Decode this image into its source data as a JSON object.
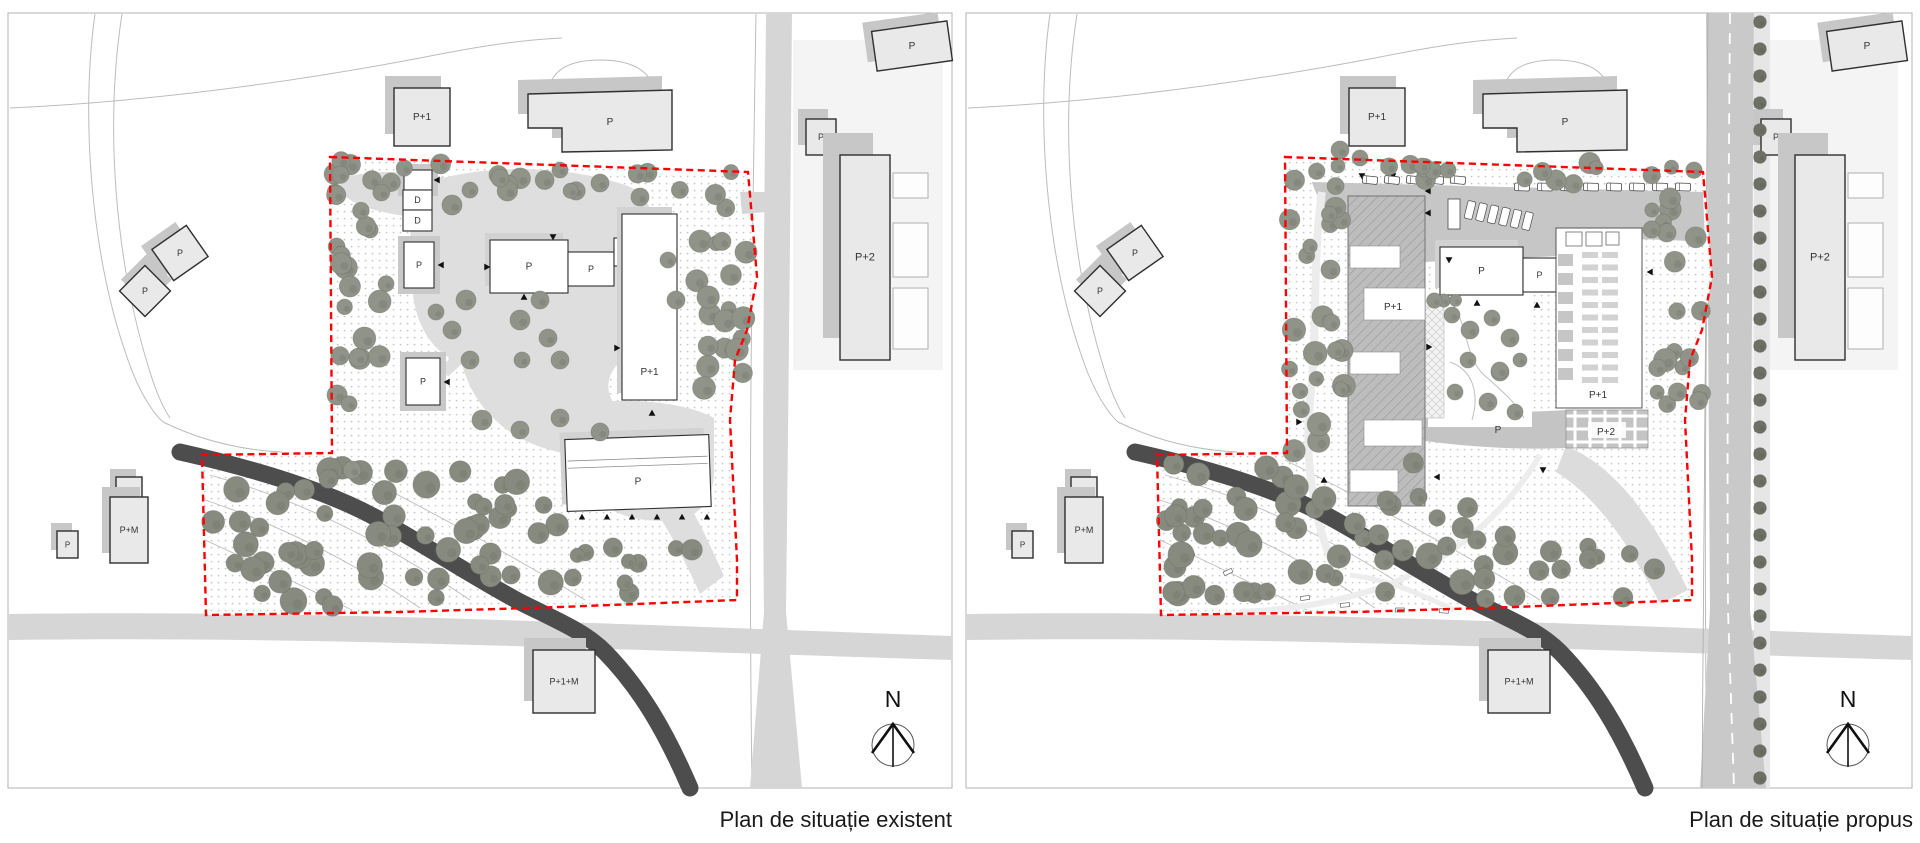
{
  "colors": {
    "boundary_red": "#ff0000",
    "river": "#4d4d4d",
    "road": "#d6d6d6",
    "road_dark": "#c9c9c9",
    "sidewalk": "#e6e6e6",
    "context_building": "#e9e9e9",
    "building_stroke": "#2f2f2f",
    "site_building": "#ffffff",
    "shadow": "#c7c7c7",
    "apron": "#c9c9c9",
    "lawn": "#dedede",
    "parking": "#c6c6c6",
    "slab": "#bdbdbd",
    "dots": "#c8c8c8",
    "tree": "#8f9388",
    "tree_dark": "#6e7266",
    "tree_forest": "#878b7f",
    "tree_street": "#6d7165",
    "label_color": "#333333",
    "frame_stroke": "#b3b3b3",
    "contour": "#bcbcbc"
  },
  "panels": [
    {
      "caption": "Plan de situație existent",
      "north_label": "N",
      "buildings": [
        {
          "label": "P+1",
          "x": 394,
          "y": 88,
          "w": 56,
          "h": 58,
          "kind": "context",
          "ext": [
            -9,
            -12
          ]
        },
        {
          "label": "P",
          "type": "poly",
          "points": [
            [
              528,
              94
            ],
            [
              672,
              90
            ],
            [
              672,
              150
            ],
            [
              562,
              152
            ],
            [
              562,
              128
            ],
            [
              528,
              128
            ]
          ],
          "lx": 610,
          "ly": 122,
          "kind": "context",
          "ext": [
            -10,
            -14
          ]
        },
        {
          "label": "P",
          "x": 806,
          "y": 119,
          "w": 30,
          "h": 36,
          "kind": "context",
          "ext": [
            -8,
            -10
          ],
          "fs": 9
        },
        {
          "label": "P+2",
          "x": 840,
          "y": 155,
          "w": 50,
          "h": 205,
          "kind": "context",
          "ext": [
            -17,
            -22
          ],
          "fs": 11
        },
        {
          "label": "P",
          "x": 874,
          "y": 26,
          "w": 76,
          "h": 40,
          "rot": -8,
          "kind": "context",
          "ext": [
            -8,
            -10
          ]
        },
        {
          "label": "P",
          "x": 159,
          "y": 234,
          "w": 42,
          "h": 38,
          "rot": -35,
          "kind": "context",
          "ext": [
            -7,
            -9
          ],
          "fs": 9
        },
        {
          "label": "P",
          "x": 127,
          "y": 273,
          "w": 36,
          "h": 36,
          "rot": 45,
          "kind": "context",
          "ext": [
            -7,
            -9
          ],
          "fs": 9
        },
        {
          "label": "",
          "x": 116,
          "y": 477,
          "w": 26,
          "h": 21,
          "kind": "context",
          "ext": [
            -6,
            -8
          ]
        },
        {
          "label": "P+M",
          "x": 110,
          "y": 497,
          "w": 38,
          "h": 66,
          "kind": "context",
          "ext": [
            -8,
            -10
          ],
          "fs": 9
        },
        {
          "label": "P",
          "x": 57,
          "y": 531,
          "w": 21,
          "h": 27,
          "kind": "context",
          "ext": [
            -6,
            -8
          ],
          "fs": 8
        },
        {
          "label": "P+1+M",
          "x": 533,
          "y": 650,
          "w": 62,
          "h": 63,
          "kind": "context",
          "ext": [
            -9,
            -12
          ],
          "fs": 9
        },
        {
          "label": "",
          "x": 404,
          "y": 170,
          "w": 28,
          "h": 20,
          "kind": "site",
          "apron": true
        },
        {
          "label": "D",
          "x": 403,
          "y": 190,
          "w": 29,
          "h": 20,
          "kind": "site",
          "fs": 9
        },
        {
          "label": "D",
          "x": 403,
          "y": 210,
          "w": 29,
          "h": 21,
          "kind": "site",
          "fs": 9
        },
        {
          "label": "P",
          "x": 404,
          "y": 242,
          "w": 30,
          "h": 46,
          "kind": "site",
          "apron": true,
          "fs": 9
        },
        {
          "label": "P",
          "x": 406,
          "y": 358,
          "w": 34,
          "h": 47,
          "kind": "site",
          "apron": true,
          "fs": 9
        },
        {
          "label": "P",
          "x": 490,
          "y": 240,
          "w": 78,
          "h": 53,
          "kind": "site"
        },
        {
          "label": "P",
          "x": 568,
          "y": 252,
          "w": 46,
          "h": 34,
          "kind": "site",
          "fs": 9
        },
        {
          "label": "",
          "x": 614,
          "y": 238,
          "w": 26,
          "h": 28,
          "kind": "site"
        },
        {
          "label": "P+1",
          "x": 622,
          "y": 214,
          "w": 55,
          "h": 186,
          "kind": "site",
          "lpy": 0.85
        },
        {
          "label": "P",
          "x": 566,
          "y": 437,
          "w": 144,
          "h": 72,
          "rot": -2,
          "kind": "site",
          "ridges": true
        }
      ]
    },
    {
      "caption": "Plan de situație propus",
      "north_label": "N",
      "buildings": [
        {
          "label": "P+1",
          "x": 1349,
          "y": 88,
          "w": 56,
          "h": 58,
          "kind": "context",
          "ext": [
            -9,
            -12
          ]
        },
        {
          "label": "P",
          "type": "poly",
          "points": [
            [
              1483,
              94
            ],
            [
              1627,
              90
            ],
            [
              1627,
              150
            ],
            [
              1517,
              152
            ],
            [
              1517,
              128
            ],
            [
              1483,
              128
            ]
          ],
          "lx": 1565,
          "ly": 122,
          "kind": "context",
          "ext": [
            -10,
            -14
          ]
        },
        {
          "label": "P",
          "x": 1761,
          "y": 119,
          "w": 30,
          "h": 36,
          "kind": "context",
          "ext": [
            -8,
            -10
          ],
          "fs": 9
        },
        {
          "label": "P+2",
          "x": 1795,
          "y": 155,
          "w": 50,
          "h": 205,
          "kind": "context",
          "ext": [
            -17,
            -22
          ],
          "fs": 11
        },
        {
          "label": "P",
          "x": 1829,
          "y": 26,
          "w": 76,
          "h": 40,
          "rot": -8,
          "kind": "context",
          "ext": [
            -8,
            -10
          ]
        },
        {
          "label": "P",
          "x": 1114,
          "y": 234,
          "w": 42,
          "h": 38,
          "rot": -35,
          "kind": "context",
          "ext": [
            -7,
            -9
          ],
          "fs": 9
        },
        {
          "label": "P",
          "x": 1082,
          "y": 273,
          "w": 36,
          "h": 36,
          "rot": 45,
          "kind": "context",
          "ext": [
            -7,
            -9
          ],
          "fs": 9
        },
        {
          "label": "",
          "x": 1071,
          "y": 477,
          "w": 26,
          "h": 21,
          "kind": "context",
          "ext": [
            -6,
            -8
          ]
        },
        {
          "label": "P+M",
          "x": 1065,
          "y": 497,
          "w": 38,
          "h": 66,
          "kind": "context",
          "ext": [
            -8,
            -10
          ],
          "fs": 9
        },
        {
          "label": "P",
          "x": 1012,
          "y": 531,
          "w": 21,
          "h": 27,
          "kind": "context",
          "ext": [
            -6,
            -8
          ],
          "fs": 8
        },
        {
          "label": "P+1+M",
          "x": 1488,
          "y": 650,
          "w": 62,
          "h": 63,
          "kind": "context",
          "ext": [
            -9,
            -12
          ],
          "fs": 9
        },
        {
          "label": "P+1",
          "type": "slab",
          "x": 1348,
          "y": 196,
          "w": 77,
          "h": 310,
          "lx": 1393,
          "ly": 307
        },
        {
          "label": "P",
          "x": 1440,
          "y": 247,
          "w": 83,
          "h": 48,
          "kind": "site"
        },
        {
          "label": "P",
          "x": 1523,
          "y": 258,
          "w": 33,
          "h": 34,
          "kind": "site",
          "fs": 9
        },
        {
          "label": "P+1",
          "type": "grid",
          "x": 1556,
          "y": 228,
          "w": 86,
          "h": 180,
          "lx": 1598,
          "ly": 395
        },
        {
          "label": "P+2",
          "type": "plaza",
          "x": 1566,
          "y": 410,
          "w": 82,
          "h": 38,
          "lx": 1606,
          "ly": 432
        },
        {
          "label": "P",
          "type": "bandlabel",
          "lx": 1498,
          "ly": 430
        }
      ]
    }
  ]
}
